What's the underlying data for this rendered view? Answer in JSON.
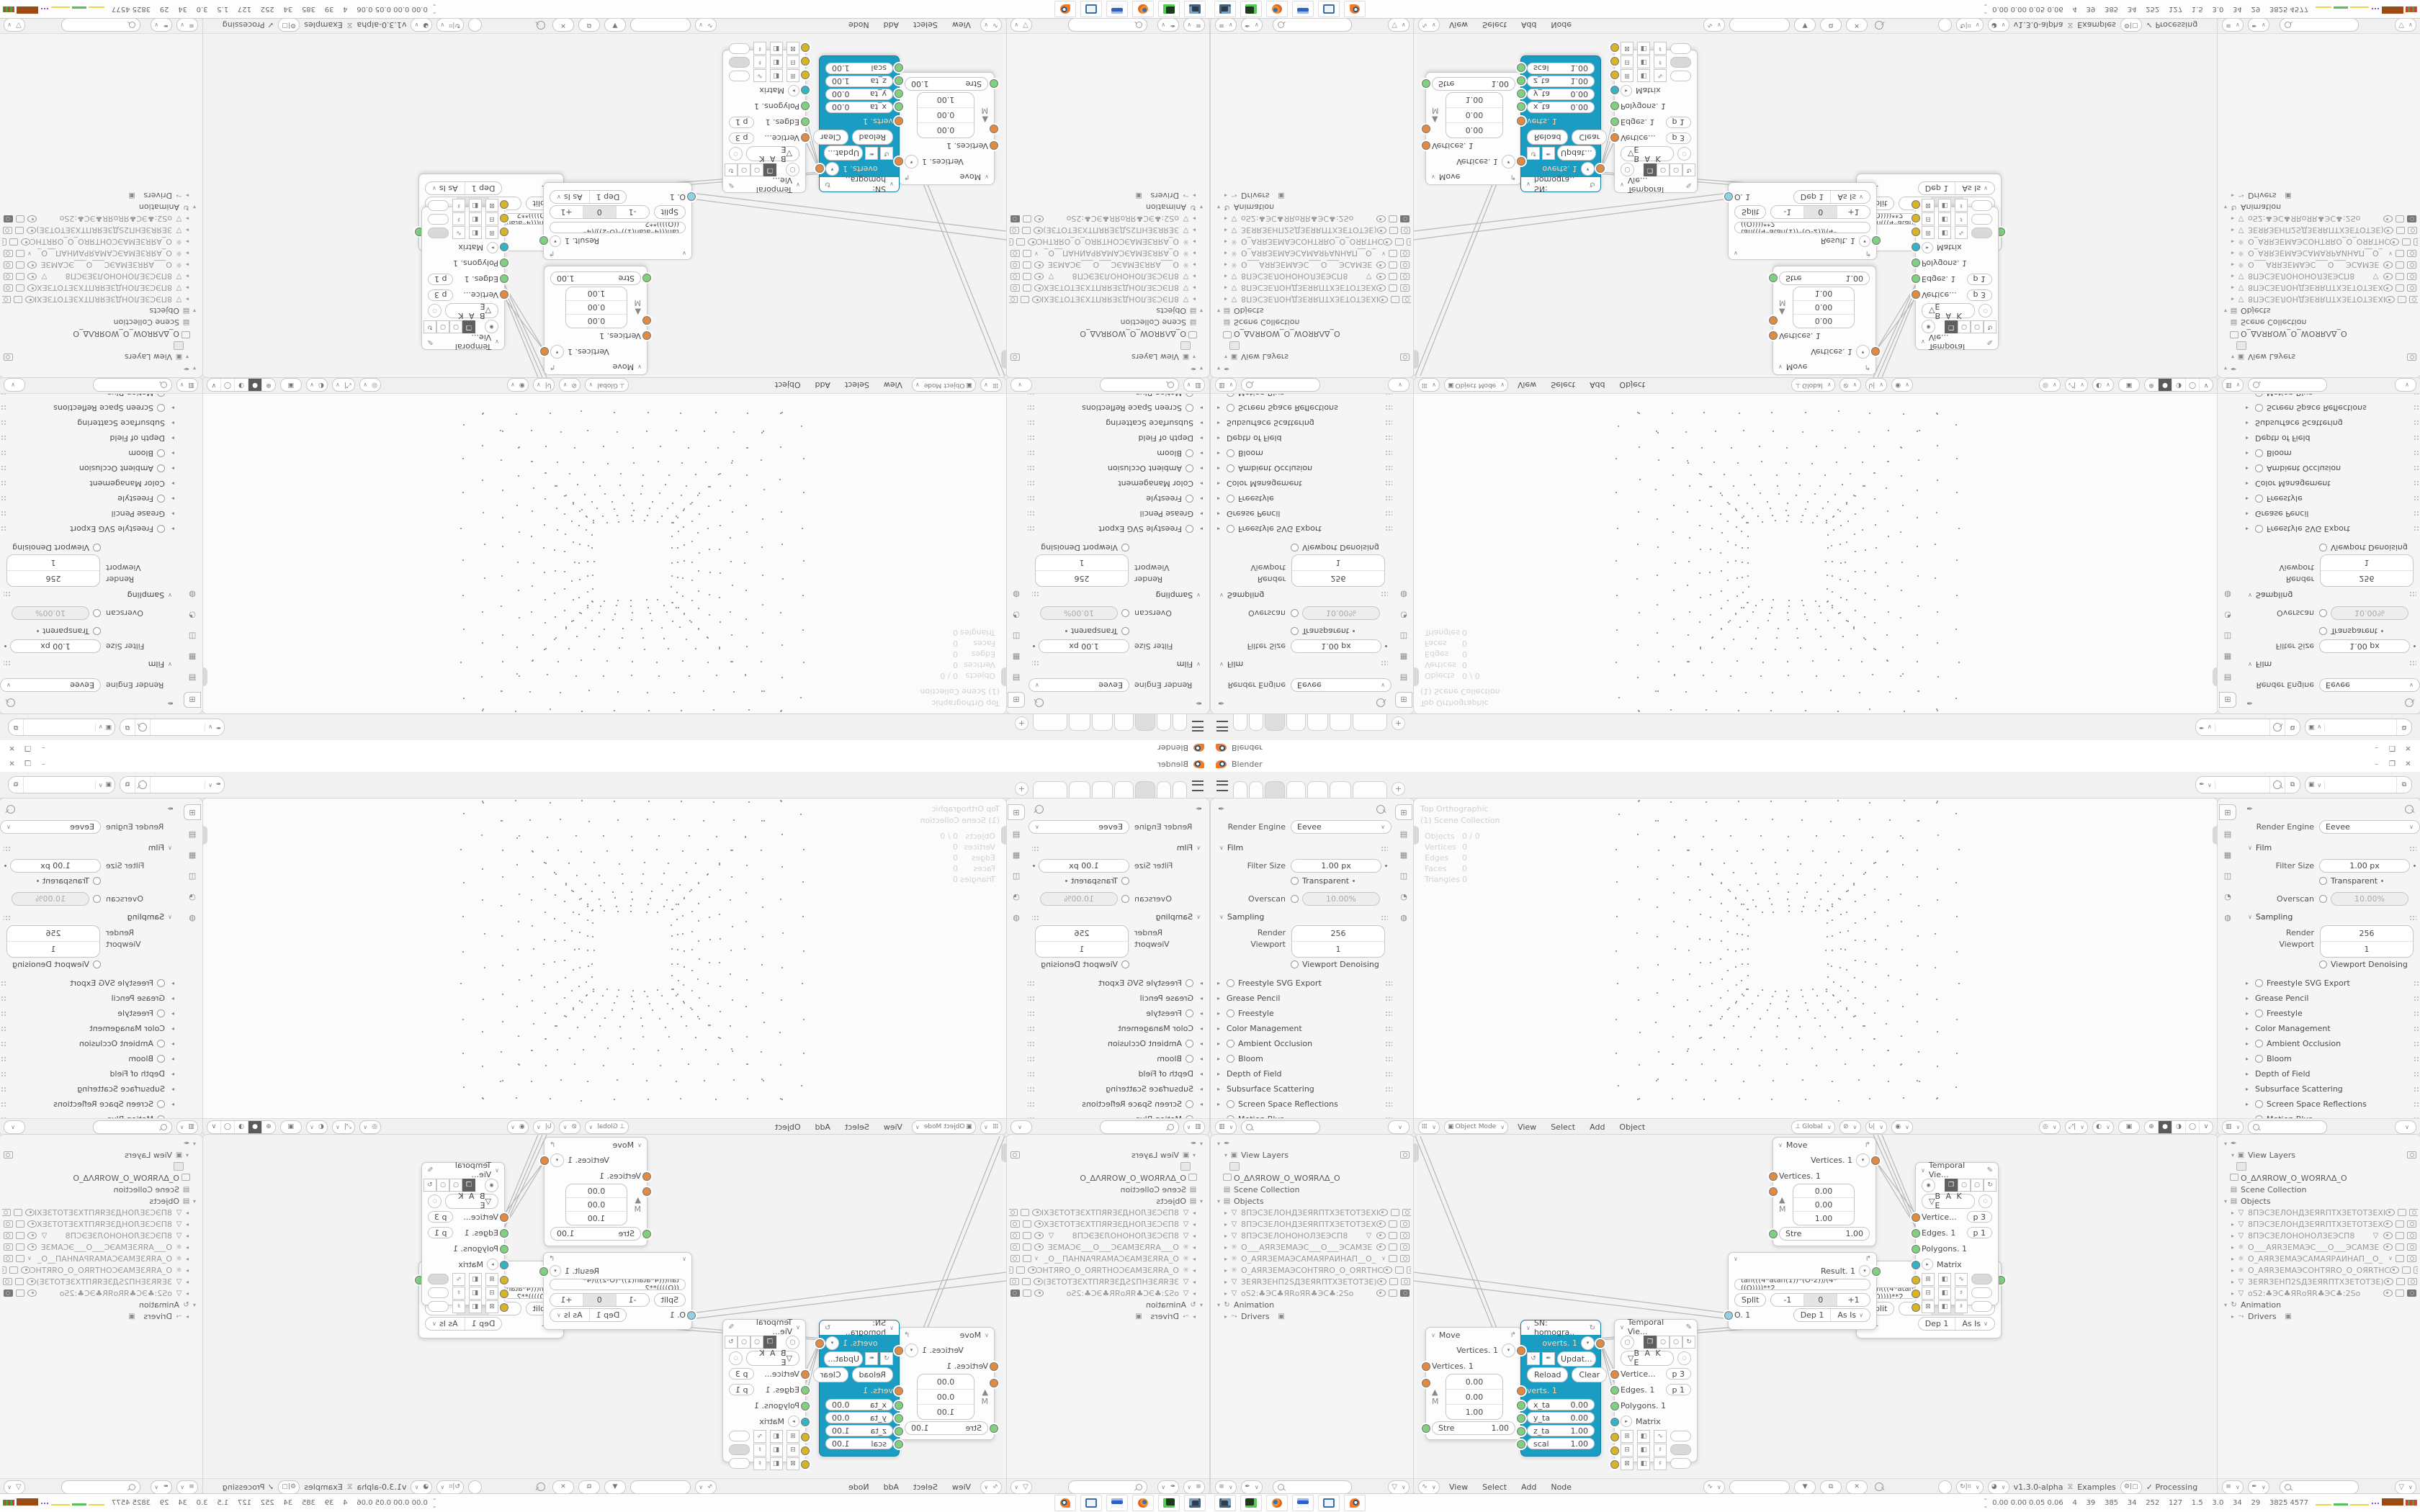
{
  "window": {
    "title": "Blender"
  },
  "topbar": {
    "tab_add_label": "+"
  },
  "properties": {
    "render_engine_label": "Render Engine",
    "render_engine": "Eevee",
    "film": {
      "title": "Film",
      "filter_size_label": "Filter Size",
      "filter_size": "1.00 px",
      "transparent_label": "Transparent",
      "overscan_label": "Overscan",
      "overscan": "10.00%"
    },
    "sampling": {
      "title": "Sampling",
      "render_label": "Render",
      "render": "256",
      "viewport_label": "Viewport",
      "viewport": "1",
      "denoising_label": "Viewport Denoising"
    },
    "panels": [
      {
        "label": "Freestyle SVG Export"
      },
      {
        "label": "Grease Pencil"
      },
      {
        "label": "Freestyle"
      },
      {
        "label": "Color Management"
      },
      {
        "label": "Ambient Occlusion"
      },
      {
        "label": "Bloom"
      },
      {
        "label": "Depth of Field"
      },
      {
        "label": "Subsurface Scattering"
      },
      {
        "label": "Screen Space Reflections"
      },
      {
        "label": "Motion Blur"
      },
      {
        "label": "Volumetrics"
      }
    ]
  },
  "viewport": {
    "overlay": {
      "view": "Top Orthographic",
      "collection": "(1) Scene Collection",
      "stats": [
        {
          "label": "Objects",
          "value": "0 / 0"
        },
        {
          "label": "Vertices",
          "value": "0"
        },
        {
          "label": "Edges",
          "value": "0"
        },
        {
          "label": "Faces",
          "value": "0"
        },
        {
          "label": "Triangles",
          "value": "0"
        }
      ]
    },
    "header": {
      "mode": "Object Mode",
      "menu_view": "View",
      "menu_select": "Select",
      "menu_add": "Add",
      "menu_object": "Object",
      "orientation": "Global"
    }
  },
  "outliner": {
    "view_layers_label": "View Layers",
    "workspace_name": "O_ΔΛЯROW_O_WOЯRΛΔ_O",
    "scene_collection_label": "Scene Collection",
    "objects_label": "Objects",
    "objects": [
      {
        "name": "8ПЭСЗЕЛОНДЗЕЯRПТХЗЕТОТЗЕХI"
      },
      {
        "name": "8ПЭСЗЕЛОНДЗЕЯRПТХЗЕТОТЗЕХ"
      },
      {
        "name": "8ПЭСЗЕЛОНОНОЛЗЕЭСП8"
      },
      {
        "name": "О___АЯRЗЕМАЭС___О___ЭСАМЗЕ"
      },
      {
        "name": "О_АЯRЗЕМАЭСАМАЯРАИНАП__О_"
      },
      {
        "name": "О_АЯRЗЕМАЭСОНТЯRО_О_ОЯRТНС"
      },
      {
        "name": "ЗЕЯRЗЕНП2SДЗЕЯRПТХЗЕТОТЗЕ)"
      },
      {
        "name": "оS2:♣ЭС♣ЯRоЯR♣ЭС♣:2Sо"
      }
    ],
    "animation_label": "Animation",
    "drivers_label": "Drivers"
  },
  "node_editor": {
    "menu_view": "View",
    "menu_select": "Select",
    "menu_add": "Add",
    "menu_node": "Node",
    "version": "v1.3.0-alpha",
    "examples_label": "Examples",
    "processing_label": "Processing",
    "nodes": {
      "move": {
        "title": "Move",
        "output": "Vertices. 1",
        "input": "Vertices. 1",
        "x": "0.00",
        "y": "0.00",
        "z": "1.00",
        "matrix_label": "M",
        "strength_label": "Stre",
        "strength": "1.00"
      },
      "sn": {
        "title": "SN: homogra..",
        "output": "overts. 1",
        "update_label": "Updat...",
        "reload_label": "Reload",
        "clear_label": "Clear",
        "verts_label": "verts. 1",
        "params": [
          {
            "label": "x_ta",
            "value": "0.00"
          },
          {
            "label": "y_ta",
            "value": "0.00"
          },
          {
            "label": "z_ta",
            "value": "1.00"
          },
          {
            "label": "scal",
            "value": "1.00"
          }
        ]
      },
      "temporal": {
        "title": "Temporal Vie...",
        "bake_label": "B A K E",
        "vertices_label": "Vertice...",
        "vertices_value": "p  3",
        "edges_label": "Edges. 1",
        "edges_value": "p  1",
        "polygons_label": "Polygons. 1",
        "matrix_label": "Matrix"
      },
      "expression": {
        "result": "Result. 1",
        "formula": "tan(((4*atan(1))*(O-2))/(4*((O))))**2",
        "split_label": "Split",
        "minus": "-1",
        "zero": "0",
        "plus": "+1",
        "output": "O. 1",
        "dep": "Dep  1",
        "mode": "As Is"
      }
    }
  },
  "taskbar": {
    "stats": "0.00 0.00 0.05 0.06    4    39    385    34    252    127    1.5    3.0    34    29    3825 4577"
  }
}
